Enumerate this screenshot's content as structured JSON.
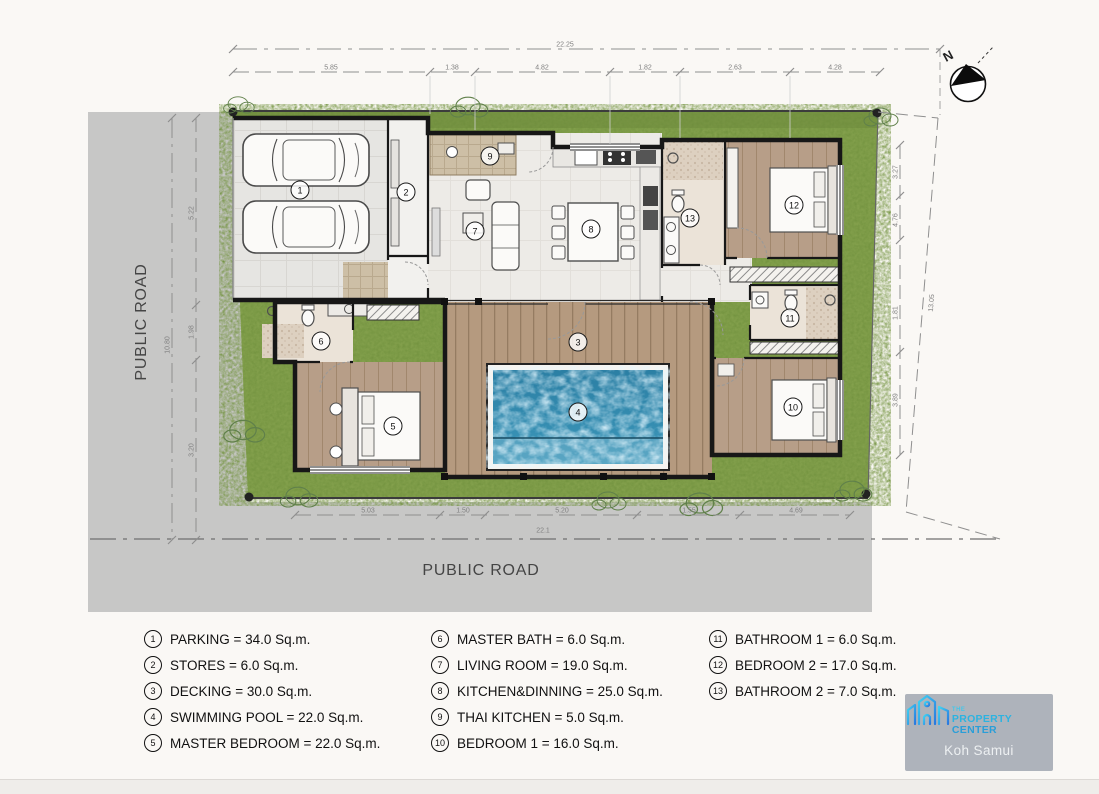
{
  "roads": {
    "left_label": "PUBLIC ROAD",
    "bottom_label": "PUBLIC ROAD"
  },
  "north": {
    "label": "N"
  },
  "legend": {
    "items": [
      {
        "num": "1",
        "label": "PARKING = 34.0 Sq.m."
      },
      {
        "num": "2",
        "label": "STORES = 6.0 Sq.m."
      },
      {
        "num": "3",
        "label": "DECKING = 30.0 Sq.m."
      },
      {
        "num": "4",
        "label": "SWIMMING POOL = 22.0 Sq.m."
      },
      {
        "num": "5",
        "label": "MASTER BEDROOM = 22.0 Sq.m."
      },
      {
        "num": "6",
        "label": "MASTER BATH = 6.0 Sq.m."
      },
      {
        "num": "7",
        "label": "LIVING ROOM = 19.0 Sq.m."
      },
      {
        "num": "8",
        "label": "KITCHEN&DINNING = 25.0 Sq.m."
      },
      {
        "num": "9",
        "label": "THAI KITCHEN = 5.0 Sq.m."
      },
      {
        "num": "10",
        "label": "BEDROOM 1 = 16.0 Sq.m."
      },
      {
        "num": "11",
        "label": "BATHROOM 1 = 6.0 Sq.m."
      },
      {
        "num": "12",
        "label": "BEDROOM 2 = 17.0 Sq.m."
      },
      {
        "num": "13",
        "label": "BATHROOM 2 = 7.0 Sq.m."
      }
    ]
  },
  "dimensions": {
    "top_total": "22.25",
    "top_segments": [
      "5.85",
      "1.38",
      "4.82",
      "1.82",
      "2.63",
      "4.28"
    ],
    "bottom_total": "22.1",
    "bottom_segments": [
      "5.03",
      "1.50",
      "5.20",
      "1.55",
      "4.69"
    ],
    "left_total": "10.80",
    "left_segments": [
      "5.22",
      "1.98",
      "3.20"
    ],
    "right_total": "13.05",
    "right_segments": [
      "3.27",
      "4.76",
      "1.81",
      "3.89"
    ]
  },
  "logo": {
    "the": "THE",
    "name1": "PROPERTY",
    "name2": "CENTER",
    "location": "Koh Samui"
  },
  "colors": {
    "grass": "#83a04c",
    "pool": "#2f86aa",
    "deck": "#b59a7f",
    "road": "#c7c7c6",
    "accent": "#2cb3e0"
  }
}
